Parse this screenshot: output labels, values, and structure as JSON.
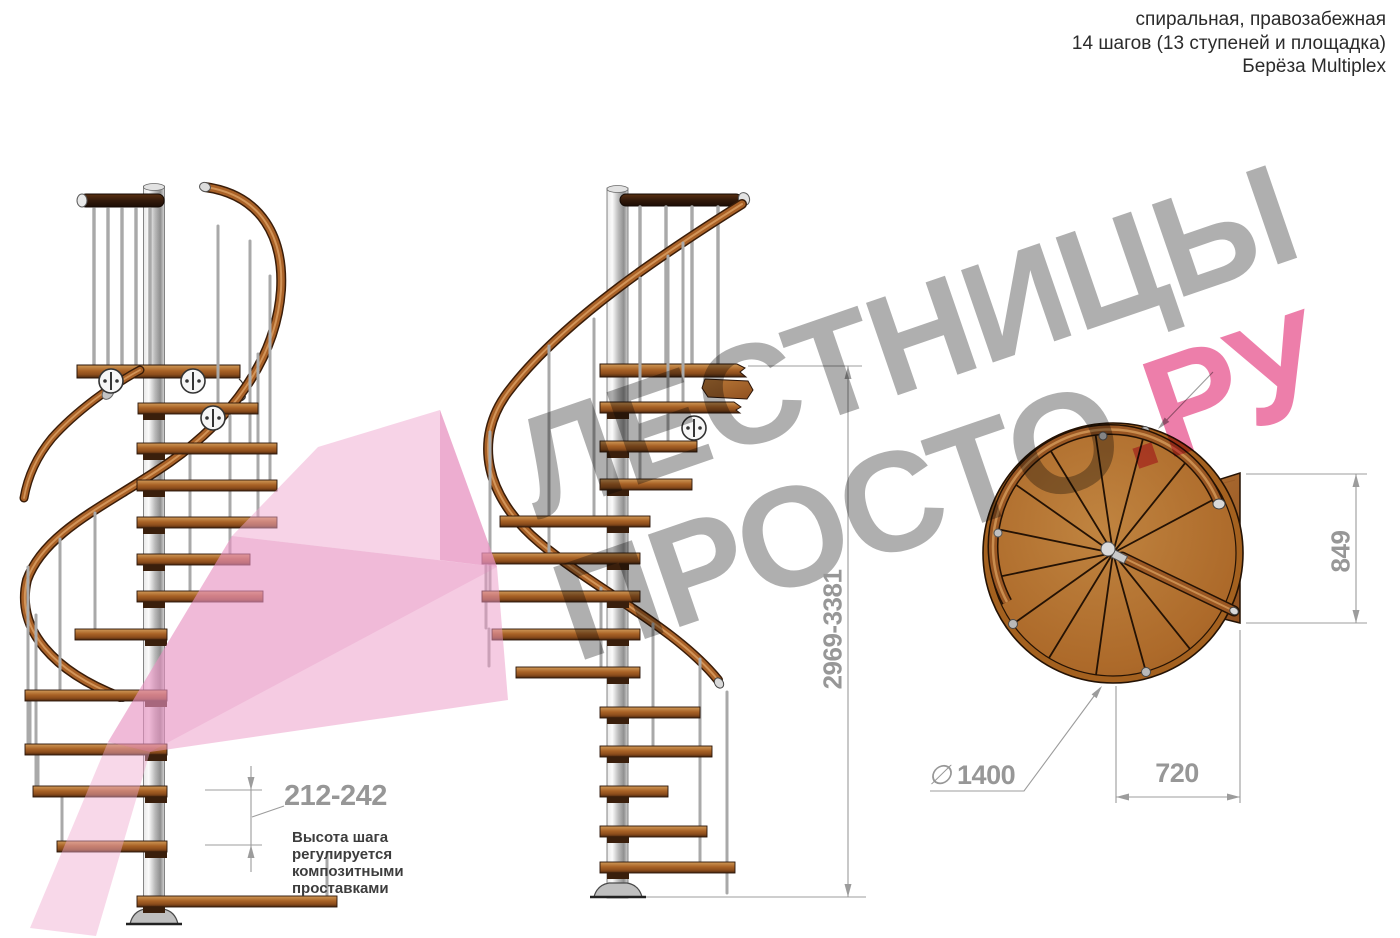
{
  "header": {
    "line1": "спиральная, правозабежная",
    "line2": "14 шагов (13 ступеней и площадка)",
    "line3": "Берёза Multiplex"
  },
  "watermark": {
    "word1": "ЛЕСТНИЦЫ",
    "word2": "ПРОСТО",
    "word3": ".РУ",
    "gray_color": "#a9a9a9",
    "pink_color": "#ec74a4"
  },
  "dimensions": {
    "total_height": "2969-3381",
    "step_rise": "212-242",
    "platform_depth": "849",
    "platform_width": "720",
    "diameter_symbol": "∅",
    "diameter_value": "1400"
  },
  "annotation": {
    "line1": "Высота шага",
    "line2": "регулируется",
    "line3": "композитными",
    "line4": "проставками"
  },
  "colors": {
    "wood_light": "#d09a58",
    "wood_mid": "#a86226",
    "wood_dark": "#47260f",
    "metal": "#c9c9c9",
    "dimension_gray": "#9c9c9c",
    "highlight_pink": "#f0a8cf"
  }
}
